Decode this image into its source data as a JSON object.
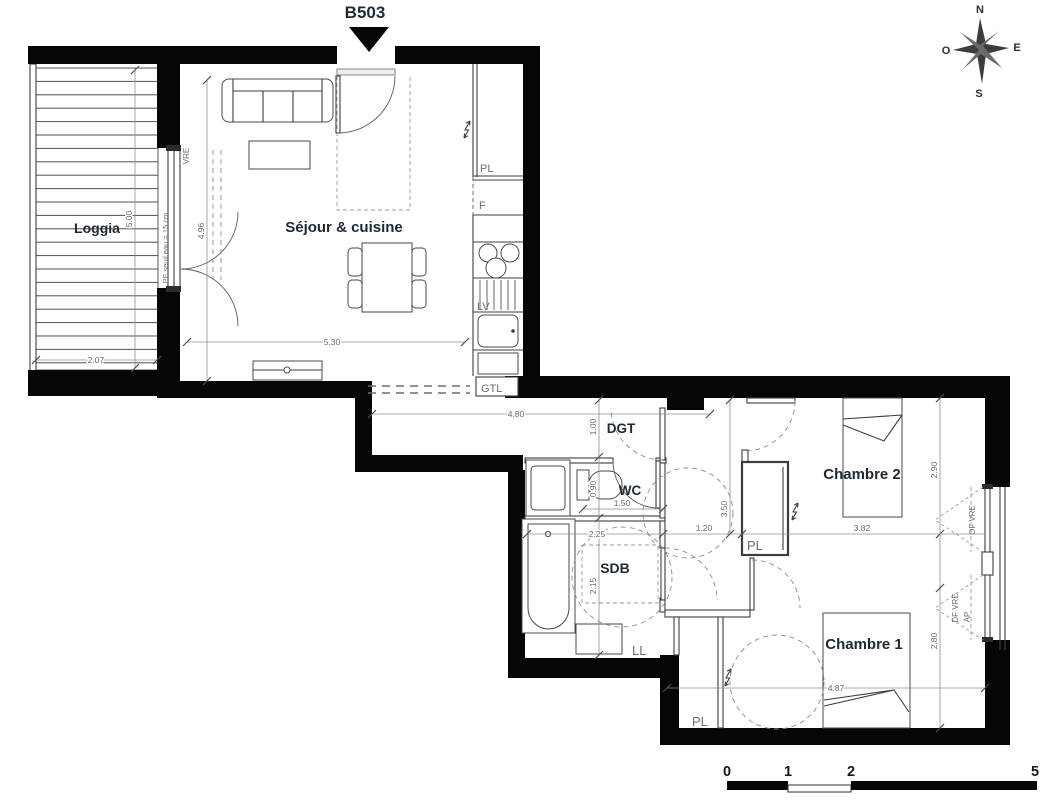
{
  "unit": {
    "label": "B503"
  },
  "compass": {
    "n": "N",
    "e": "E",
    "s": "S",
    "w": "O"
  },
  "rooms": {
    "loggia": "Loggia",
    "sejour": "Séjour & cuisine",
    "dgt": "DGT",
    "wc": "WC",
    "sdb": "SDB",
    "chambre2": "Chambre 2",
    "chambre1": "Chambre 1"
  },
  "fixtures": {
    "pl_kitchen": "PL",
    "fridge": "F",
    "dishwasher": "LV",
    "gtl": "GTL",
    "washer": "LL",
    "pl_ch2": "PL",
    "pl_ch1": "PL"
  },
  "openings": {
    "vre": "VRE",
    "pf_seuil": "PF seuil eau = 15 cm",
    "of_vre": "OF VRE",
    "df_vre": "DF VRE",
    "ap": "AP"
  },
  "dims": {
    "loggia_h": "5.00",
    "loggia_w": "2.07",
    "sejour_h": "4.96",
    "sejour_w": "5.30",
    "dgt_w": "4.80",
    "dgt_h": "1.00",
    "wc_h": "0.90",
    "wc_w": "1.50",
    "sdb_w": "2.25",
    "sdb_h": "2.15",
    "night_hall_w": "1.20",
    "night_hall_h": "3.50",
    "ch2_w": "3.82",
    "ch2_h": "2.90",
    "ch1_w": "4.87",
    "ch1_h": "2.80"
  },
  "scale": {
    "n0": "0",
    "n1": "1",
    "n2": "2",
    "n5": "5"
  },
  "colors": {
    "wall": "#060606",
    "ink": "#1f2833",
    "dim_text": "#686868",
    "code_text": "#6e6e6e",
    "line": "#3c3c3c",
    "background": "#ffffff"
  }
}
